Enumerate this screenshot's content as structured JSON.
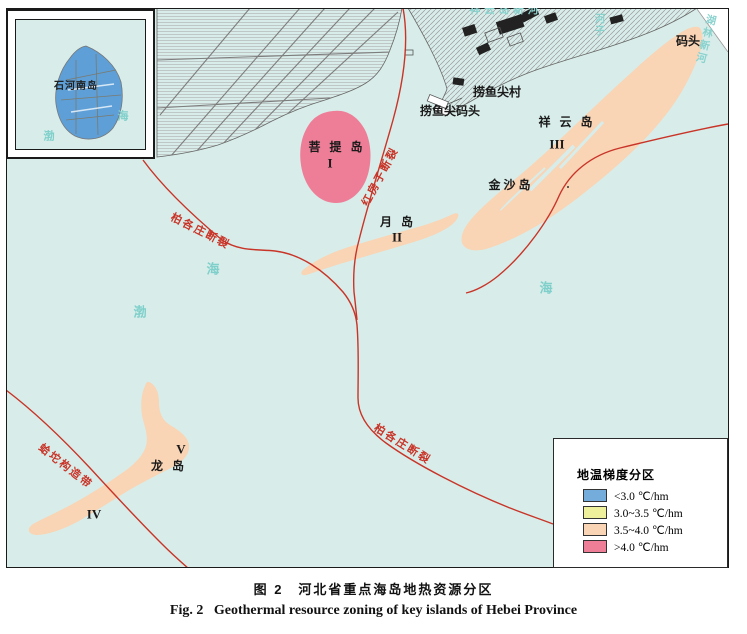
{
  "figure": {
    "caption_zh": "图 2　河北省重点海岛地热资源分区",
    "caption_en": "Fig. 2   Geothermal resource zoning of key islands of Hebei Province"
  },
  "inset": {
    "island": "石河南岛",
    "sea_left": "渤",
    "sea_right": "海"
  },
  "sea": {
    "bo": "渤",
    "hai_left": "海",
    "hai_right": "海"
  },
  "rivers": {
    "top": "祥云岛新河",
    "right": "湖\n林\n新\n河",
    "mid": "河\n子"
  },
  "places": {
    "village": "捞鱼尖村",
    "wharf_left": "捞鱼尖码头",
    "wharf_right": "码头"
  },
  "islands": {
    "putidao": {
      "name": "菩 提 岛",
      "numeral": "I"
    },
    "yuedao": {
      "name": "月 岛",
      "numeral": "II"
    },
    "xiangyundao": {
      "name": "祥 云 岛",
      "numeral": "III"
    },
    "jinshadao": {
      "name": "金沙岛"
    },
    "longdao": {
      "name": "龙 岛",
      "numeral": "V"
    },
    "zone4": {
      "numeral": "IV"
    }
  },
  "faults": {
    "hongfangzi": "红房子断裂",
    "baigezhuang_upper": "柏各庄断裂",
    "getuo": "蛤坨构造带",
    "baigezhuang_lower": "柏各庄断裂"
  },
  "legend": {
    "title": "地温梯度分区",
    "items": [
      {
        "label": "<3.0 ℃/hm",
        "color": "#74acdb"
      },
      {
        "label": "3.0~3.5 ℃/hm",
        "color": "#eef09c"
      },
      {
        "label": "3.5~4.0 ℃/hm",
        "color": "#f9d4b5"
      },
      {
        "label": ">4.0 ℃/hm",
        "color": "#ee7e97"
      }
    ]
  },
  "colors": {
    "sea": "#d8ede9",
    "fault_line": "#c93428",
    "water_text": "#7fcfcb",
    "inset_island": "#5e9fd8"
  }
}
